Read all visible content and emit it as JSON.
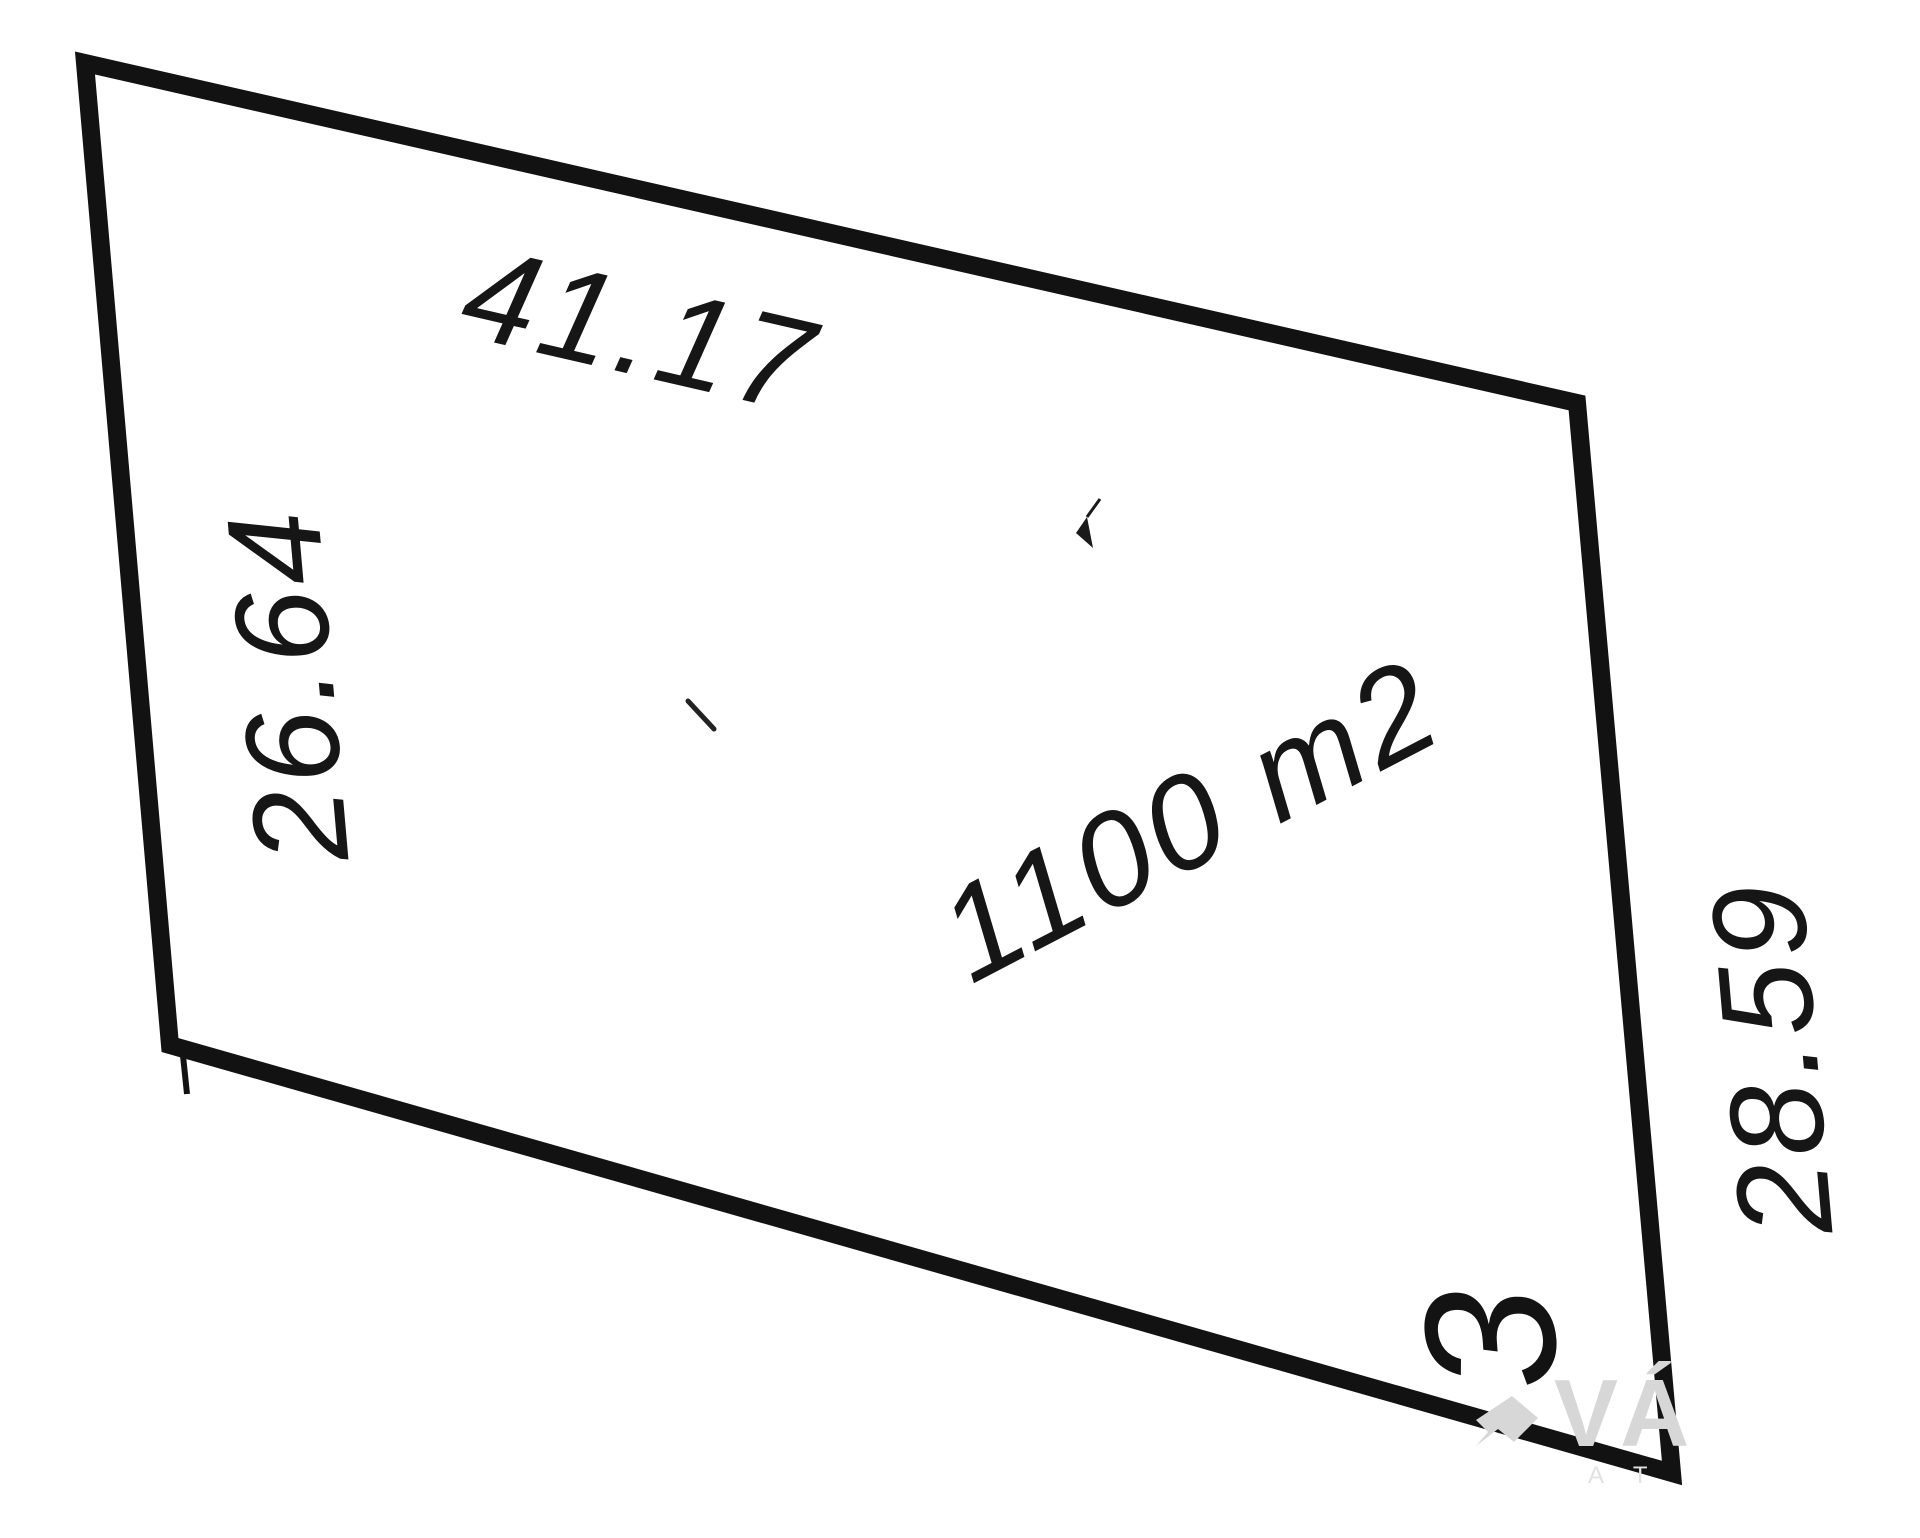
{
  "page": {
    "background": "#ffffff",
    "ink_color": "#121212",
    "watermark_color": "#d7d7d7"
  },
  "parcel": {
    "number": "3",
    "area": "1100 m2",
    "sides": {
      "top": "41.17",
      "left": "26.64",
      "right": "28.59"
    }
  },
  "watermark": {
    "text": "VÁ",
    "subtext": "A T"
  }
}
